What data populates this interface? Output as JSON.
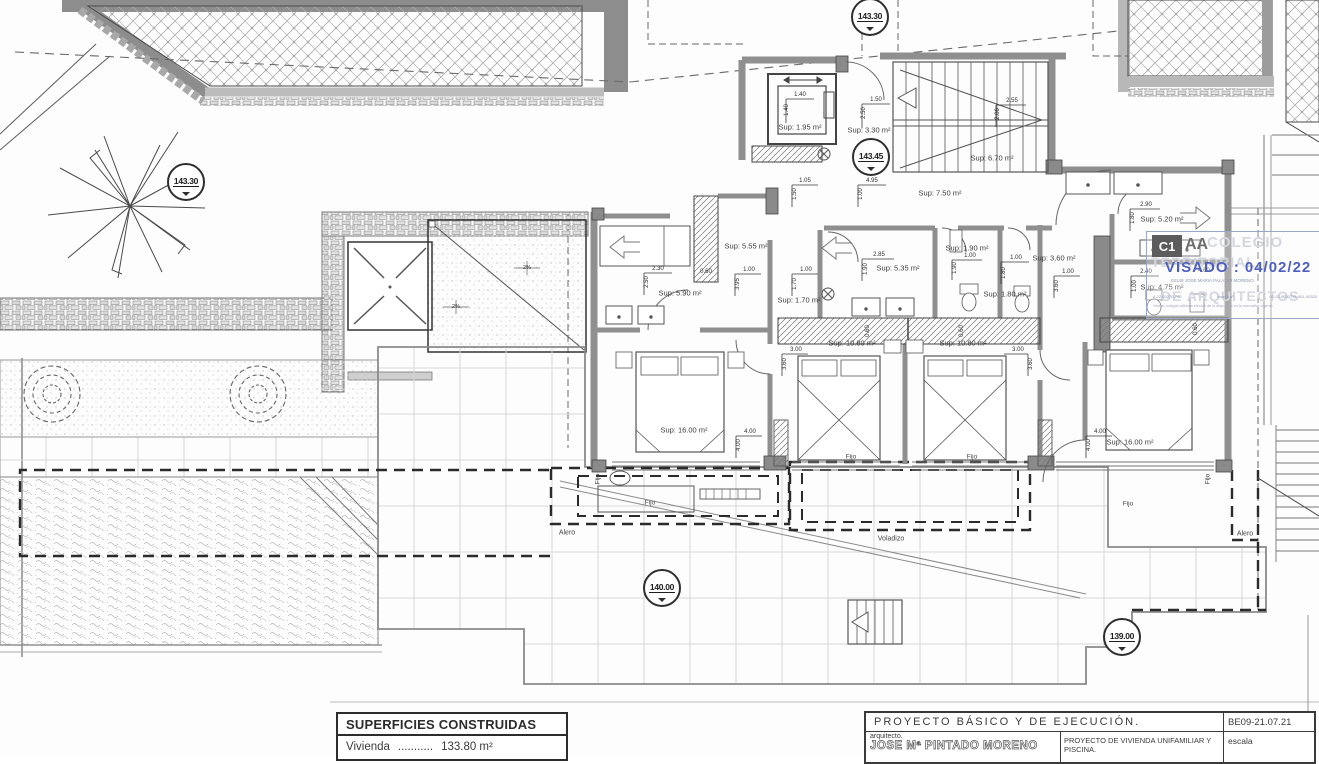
{
  "drawing": {
    "elevation_markers": [
      {
        "text": "143.30",
        "x": 186,
        "y": 182
      },
      {
        "text": "143.30",
        "x": 870,
        "y": 17
      },
      {
        "text": "143.45",
        "x": 871,
        "y": 157
      },
      {
        "text": "140.00",
        "x": 662,
        "y": 588
      },
      {
        "text": "139.00",
        "x": 1122,
        "y": 637
      }
    ],
    "annotations": [
      {
        "t": "Sup: 1.95 m²",
        "x": 800,
        "y": 127,
        "k": "area"
      },
      {
        "t": "Sup: 3.30 m²",
        "x": 869,
        "y": 130,
        "k": "area"
      },
      {
        "t": "Sup: 6.70 m²",
        "x": 992,
        "y": 158,
        "k": "area"
      },
      {
        "t": "Sup: 7.50 m²",
        "x": 940,
        "y": 193,
        "k": "area"
      },
      {
        "t": "Sup: 5.55 m²",
        "x": 746,
        "y": 246,
        "k": "area"
      },
      {
        "t": "Sup: 5.90 m²",
        "x": 680,
        "y": 293,
        "k": "area"
      },
      {
        "t": "Sup: 1.70 m²",
        "x": 799,
        "y": 300,
        "k": "area"
      },
      {
        "t": "Sup: 5.35 m²",
        "x": 898,
        "y": 268,
        "k": "area"
      },
      {
        "t": "Sup: 1.90 m²",
        "x": 967,
        "y": 248,
        "k": "area"
      },
      {
        "t": "Sup: 1.80 m²",
        "x": 1005,
        "y": 294,
        "k": "area"
      },
      {
        "t": "Sup: 3.60 m²",
        "x": 1054,
        "y": 258,
        "k": "area"
      },
      {
        "t": "Sup: 5.20 m²",
        "x": 1162,
        "y": 219,
        "k": "area"
      },
      {
        "t": "Sup: 4.75 m²",
        "x": 1162,
        "y": 287,
        "k": "area"
      },
      {
        "t": "Sup: 10.80 m²",
        "x": 852,
        "y": 343,
        "k": "area"
      },
      {
        "t": "Sup: 10.80 m²",
        "x": 963,
        "y": 343,
        "k": "area"
      },
      {
        "t": "Sup: 16.00 m²",
        "x": 684,
        "y": 430,
        "k": "area"
      },
      {
        "t": "Sup: 16.00 m²",
        "x": 1130,
        "y": 442,
        "k": "area"
      },
      {
        "t": "1.40",
        "x": 800,
        "y": 95,
        "k": "dim"
      },
      {
        "t": "1.40",
        "x": 787,
        "y": 110,
        "k": "dim",
        "r": 1
      },
      {
        "t": "1.50",
        "x": 876,
        "y": 100,
        "k": "dim"
      },
      {
        "t": "2.50",
        "x": 864,
        "y": 113,
        "k": "dim",
        "r": 1
      },
      {
        "t": "2.55",
        "x": 1012,
        "y": 101,
        "k": "dim"
      },
      {
        "t": "2.06",
        "x": 998,
        "y": 114,
        "k": "dim",
        "r": 1
      },
      {
        "t": "1.05",
        "x": 805,
        "y": 181,
        "k": "dim"
      },
      {
        "t": "1.50",
        "x": 795,
        "y": 194,
        "k": "dim",
        "r": 1
      },
      {
        "t": "4.95",
        "x": 872,
        "y": 181,
        "k": "dim"
      },
      {
        "t": "1.00",
        "x": 861,
        "y": 194,
        "k": "dim",
        "r": 1
      },
      {
        "t": "2.30",
        "x": 658,
        "y": 269,
        "k": "dim"
      },
      {
        "t": "2.50",
        "x": 647,
        "y": 282,
        "k": "dim",
        "r": 1
      },
      {
        "t": "0.60",
        "x": 706,
        "y": 272,
        "k": "dim"
      },
      {
        "t": "1.00",
        "x": 749,
        "y": 270,
        "k": "dim"
      },
      {
        "t": "3.95",
        "x": 738,
        "y": 284,
        "k": "dim",
        "r": 1
      },
      {
        "t": "1.00",
        "x": 806,
        "y": 270,
        "k": "dim"
      },
      {
        "t": "1.70",
        "x": 795,
        "y": 284,
        "k": "dim",
        "r": 1
      },
      {
        "t": "2.85",
        "x": 879,
        "y": 255,
        "k": "dim"
      },
      {
        "t": "1.90",
        "x": 866,
        "y": 269,
        "k": "dim",
        "r": 1
      },
      {
        "t": "1.00",
        "x": 970,
        "y": 256,
        "k": "dim"
      },
      {
        "t": "1.90",
        "x": 955,
        "y": 268,
        "k": "dim",
        "r": 1
      },
      {
        "t": "1.00",
        "x": 1016,
        "y": 258,
        "k": "dim"
      },
      {
        "t": "1.80",
        "x": 1004,
        "y": 273,
        "k": "dim",
        "r": 1
      },
      {
        "t": "1.00",
        "x": 1068,
        "y": 272,
        "k": "dim"
      },
      {
        "t": "3.60",
        "x": 1057,
        "y": 286,
        "k": "dim",
        "r": 1
      },
      {
        "t": "2.90",
        "x": 1146,
        "y": 205,
        "k": "dim"
      },
      {
        "t": "1.80",
        "x": 1133,
        "y": 218,
        "k": "dim",
        "r": 1
      },
      {
        "t": "2.40",
        "x": 1146,
        "y": 272,
        "k": "dim"
      },
      {
        "t": "1.00",
        "x": 1135,
        "y": 286,
        "k": "dim",
        "r": 1
      },
      {
        "t": "4.60",
        "x": 1204,
        "y": 271,
        "k": "dim"
      },
      {
        "t": "3.00",
        "x": 796,
        "y": 350,
        "k": "dim"
      },
      {
        "t": "3.60",
        "x": 785,
        "y": 364,
        "k": "dim",
        "r": 1
      },
      {
        "t": "3.00",
        "x": 1018,
        "y": 350,
        "k": "dim"
      },
      {
        "t": "3.60",
        "x": 1031,
        "y": 364,
        "k": "dim",
        "r": 1
      },
      {
        "t": "4.00",
        "x": 750,
        "y": 432,
        "k": "dim"
      },
      {
        "t": "4.00",
        "x": 739,
        "y": 445,
        "k": "dim",
        "r": 1
      },
      {
        "t": "4.00",
        "x": 1100,
        "y": 432,
        "k": "dim"
      },
      {
        "t": "4.00",
        "x": 1089,
        "y": 445,
        "k": "dim",
        "r": 1
      },
      {
        "t": "0.60",
        "x": 868,
        "y": 331,
        "k": "dim",
        "r": 1
      },
      {
        "t": "0.60",
        "x": 962,
        "y": 331,
        "k": "dim",
        "r": 1
      },
      {
        "t": "0.60",
        "x": 1196,
        "y": 329,
        "k": "dim",
        "r": 1
      },
      {
        "t": "Fijo",
        "x": 598,
        "y": 479,
        "k": "win",
        "r": 1
      },
      {
        "t": "Fijo",
        "x": 650,
        "y": 503,
        "k": "win"
      },
      {
        "t": "Fijo",
        "x": 851,
        "y": 457,
        "k": "win"
      },
      {
        "t": "Fijo",
        "x": 972,
        "y": 457,
        "k": "win"
      },
      {
        "t": "Fijo",
        "x": 1208,
        "y": 479,
        "k": "win",
        "r": 1
      },
      {
        "t": "Fijo",
        "x": 1128,
        "y": 504,
        "k": "win"
      },
      {
        "t": "Alero",
        "x": 567,
        "y": 533,
        "k": "eave"
      },
      {
        "t": "Voladizo",
        "x": 891,
        "y": 539,
        "k": "eave"
      },
      {
        "t": "Alero",
        "x": 1245,
        "y": 534,
        "k": "eave"
      },
      {
        "t": "2%",
        "x": 527,
        "y": 268,
        "k": "slope"
      },
      {
        "t": "2%",
        "x": 456,
        "y": 307,
        "k": "slope"
      }
    ]
  },
  "surfaces_box": {
    "title": "SUPERFICIES CONSTRUIDAS",
    "row_label": "Vivienda",
    "row_dots": "...........",
    "row_value": "133.80 m²"
  },
  "stamp": {
    "logo_left": "C1",
    "logo_right": "AA",
    "watermark_top": "COLEGIO",
    "watermark_mid": "TERRITORIAL",
    "watermark_bottom": "DE ARQUITECTOS",
    "visado_label": "VISADO",
    "visado_sep": ":",
    "visado_date": "04/02/22",
    "registrant": "02149 JOSE MARIA PALACIO MORENO",
    "micro_left": "8-22-02270-700",
    "micro_mid": "visado nº",
    "micro_right": "02-22-0000794-001-00320",
    "micro_note": "Visado colegial válido a efectos de lo dispuesto en la normativa vigente"
  },
  "title_block": {
    "project_title": "PROYECTO  BÁSICO  Y  DE  EJECUCIÓN.",
    "code": "BE09-21.07.21",
    "architect_label": "arquitecto.",
    "architect_name": "JOSE Mª PINTADO MORENO",
    "project_description": "PROYECTO DE VIVIENDA UNIFAMILIAR Y PISCINA.",
    "scale_label": "escala"
  }
}
